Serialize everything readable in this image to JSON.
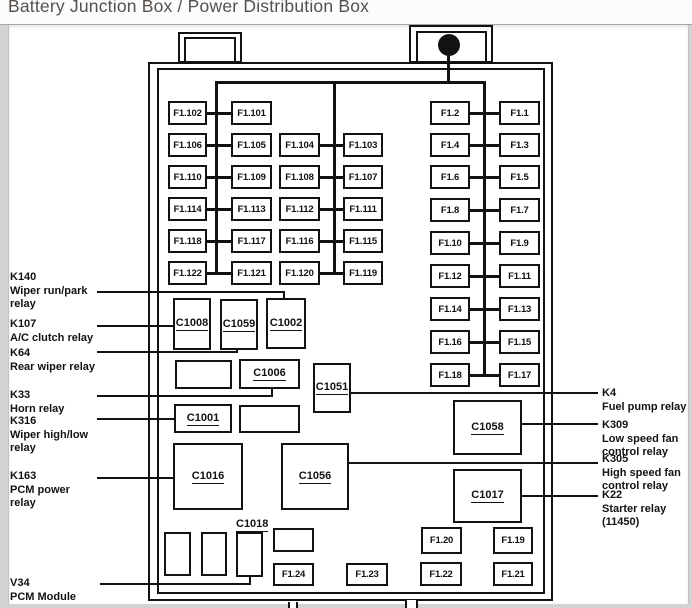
{
  "title": "Battery Junction Box / Power Distribution Box",
  "colors": {
    "line": "#121212",
    "title_text": "#55504b",
    "page_bg": "#d3d3d3",
    "panel_bg": "#ffffff"
  },
  "fuse_grid_left": {
    "pairs_ab": [
      [
        "F1.102",
        "F1.101"
      ],
      [
        "F1.106",
        "F1.105"
      ],
      [
        "F1.110",
        "F1.109"
      ],
      [
        "F1.114",
        "F1.113"
      ],
      [
        "F1.118",
        "F1.117"
      ],
      [
        "F1.122",
        "F1.121"
      ]
    ],
    "pairs_cd": [
      [
        "F1.104",
        "F1.103"
      ],
      [
        "F1.108",
        "F1.107"
      ],
      [
        "F1.112",
        "F1.111"
      ],
      [
        "F1.116",
        "F1.115"
      ],
      [
        "F1.120",
        "F1.119"
      ]
    ]
  },
  "fuse_grid_right": {
    "pairs": [
      [
        "F1.2",
        "F1.1"
      ],
      [
        "F1.4",
        "F1.3"
      ],
      [
        "F1.6",
        "F1.5"
      ],
      [
        "F1.8",
        "F1.7"
      ],
      [
        "F1.10",
        "F1.9"
      ],
      [
        "F1.12",
        "F1.11"
      ],
      [
        "F1.14",
        "F1.13"
      ],
      [
        "F1.16",
        "F1.15"
      ],
      [
        "F1.18",
        "F1.17"
      ]
    ]
  },
  "connectors": [
    {
      "label": "C1008",
      "x": 173,
      "y": 298,
      "w": 38,
      "h": 52
    },
    {
      "label": "C1059",
      "x": 220,
      "y": 299,
      "w": 38,
      "h": 51
    },
    {
      "label": "C1002",
      "x": 266,
      "y": 298,
      "w": 40,
      "h": 51
    },
    {
      "label": "",
      "x": 175,
      "y": 360,
      "w": 57,
      "h": 29
    },
    {
      "label": "C1006",
      "x": 239,
      "y": 359,
      "w": 61,
      "h": 30
    },
    {
      "label": "C1051",
      "x": 313,
      "y": 363,
      "w": 38,
      "h": 50
    },
    {
      "label": "C1001",
      "x": 174,
      "y": 404,
      "w": 58,
      "h": 29
    },
    {
      "label": "",
      "x": 239,
      "y": 405,
      "w": 61,
      "h": 28
    },
    {
      "label": "C1016",
      "x": 173,
      "y": 443,
      "w": 70,
      "h": 67
    },
    {
      "label": "C1056",
      "x": 281,
      "y": 443,
      "w": 68,
      "h": 67
    },
    {
      "label": "C1058",
      "x": 453,
      "y": 400,
      "w": 69,
      "h": 55
    },
    {
      "label": "C1017",
      "x": 453,
      "y": 469,
      "w": 69,
      "h": 54
    },
    {
      "label": "",
      "x": 164,
      "y": 532,
      "w": 27,
      "h": 44
    },
    {
      "label": "",
      "x": 201,
      "y": 532,
      "w": 26,
      "h": 44
    },
    {
      "label": "",
      "x": 236,
      "y": 532,
      "w": 27,
      "h": 45
    },
    {
      "label": "",
      "x": 273,
      "y": 528,
      "w": 41,
      "h": 24
    }
  ],
  "standalone_label": {
    "text": "C1018",
    "x": 236,
    "y": 514
  },
  "bottom_fuses": [
    {
      "label": "F1.24",
      "x": 273,
      "y": 563,
      "w": 41,
      "h": 23
    },
    {
      "label": "F1.23",
      "x": 346,
      "y": 563,
      "w": 42,
      "h": 23
    },
    {
      "label": "F1.22",
      "x": 420,
      "y": 562,
      "w": 42,
      "h": 24
    },
    {
      "label": "F1.21",
      "x": 493,
      "y": 562,
      "w": 40,
      "h": 24
    },
    {
      "label": "F1.20",
      "x": 421,
      "y": 527,
      "w": 41,
      "h": 27
    },
    {
      "label": "F1.19",
      "x": 493,
      "y": 527,
      "w": 40,
      "h": 27
    }
  ],
  "left_labels": [
    {
      "id": "K140",
      "lines": [
        "K140",
        "Wiper run/park",
        "relay"
      ],
      "y": 271
    },
    {
      "id": "K107",
      "lines": [
        "K107",
        "A/C clutch relay"
      ],
      "y": 318
    },
    {
      "id": "K64",
      "lines": [
        "K64",
        "Rear wiper relay"
      ],
      "y": 347
    },
    {
      "id": "K33",
      "lines": [
        "K33",
        "Horn relay"
      ],
      "y": 389
    },
    {
      "id": "K316",
      "lines": [
        "K316",
        "Wiper high/low",
        "relay"
      ],
      "y": 415
    },
    {
      "id": "K163",
      "lines": [
        "K163",
        "PCM power",
        "relay"
      ],
      "y": 470
    },
    {
      "id": "V34",
      "lines": [
        "V34",
        "PCM Module"
      ],
      "y": 577
    }
  ],
  "right_labels": [
    {
      "id": "K4",
      "lines": [
        "K4",
        "Fuel pump relay"
      ],
      "y": 387
    },
    {
      "id": "K309",
      "lines": [
        "K309",
        "Low speed fan",
        "control relay"
      ],
      "y": 419
    },
    {
      "id": "K305",
      "lines": [
        "K305",
        "High speed fan",
        "control relay"
      ],
      "y": 453
    },
    {
      "id": "K22",
      "lines": [
        "K22",
        "Starter relay",
        "(11450)"
      ],
      "y": 489
    }
  ]
}
